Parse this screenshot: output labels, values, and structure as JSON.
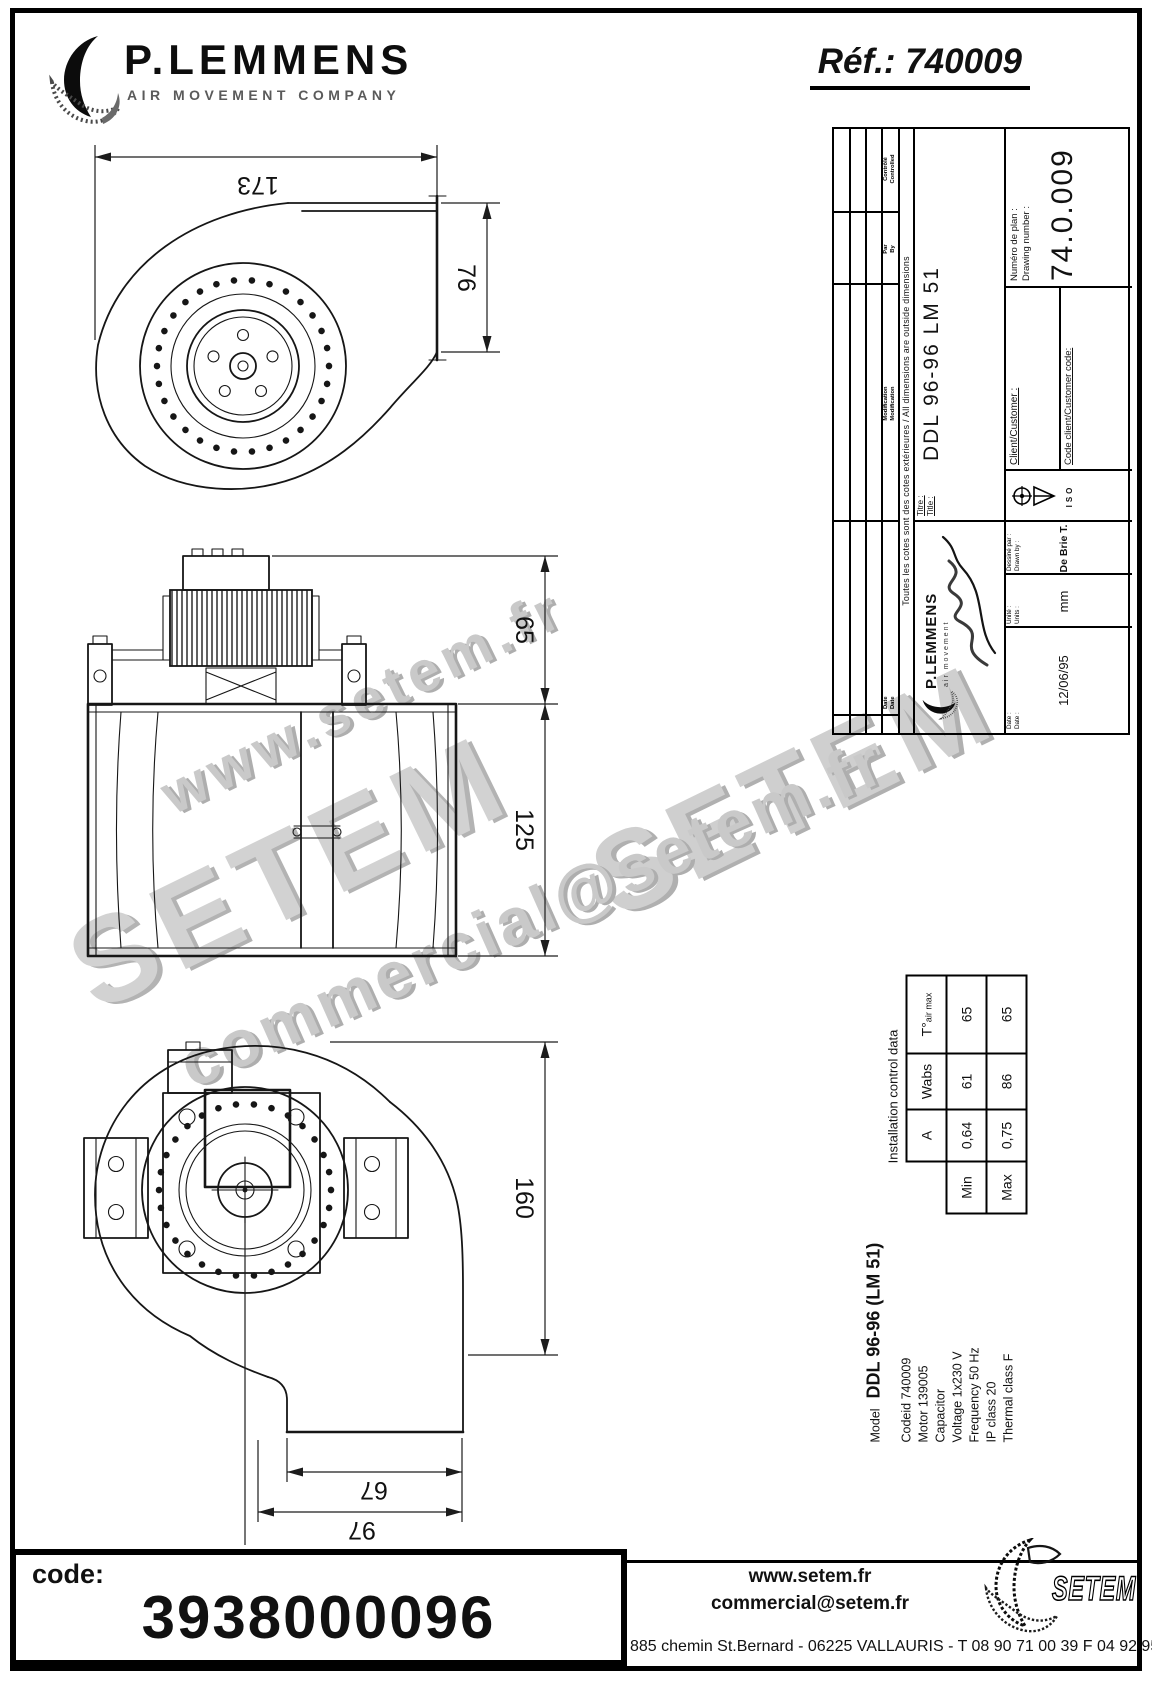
{
  "header": {
    "brand": "P.LEMMENS",
    "brand_sub": "AIR MOVEMENT COMPANY",
    "ref": "Réf.: 740009"
  },
  "dims": {
    "width_top": "173",
    "outlet": "76",
    "motor": "65",
    "housing": "125",
    "overall": "160",
    "base_inner": "67",
    "base_outer": "97"
  },
  "tb": {
    "rev": {
      "date_fr": "Date",
      "date_en": "Date",
      "mod_fr": "Modification",
      "mod_en": "Modification",
      "par_fr": "Par",
      "par_en": "By",
      "ctl_fr": "Contrôlé",
      "ctl_en": "Controlled"
    },
    "note": "Toutes les cotes sont des cotes extérieures / All dimensions are outside dimensions",
    "title_fr": "Titre :",
    "title_en": "Title :",
    "title_val": "DDL 96-96 LM 51",
    "num_fr": "Numéro de plan :",
    "num_en": "Drawing number :",
    "num_val": "74.0.009",
    "client": "Client/Customer :",
    "client_code": "Code client/Customer code:",
    "iso": "ISO",
    "date_fr": "Date :",
    "date_en": "Date :",
    "date_val": "12/06/95",
    "unit_fr": "Unité :",
    "unit_en": "Units :",
    "unit_val": "mm",
    "drawn_fr": "Dessiné par :",
    "drawn_en": "Drawn by :",
    "drawn_val": "De Brie T.",
    "logo_brand": "P.LEMMENS",
    "logo_sub": "air movement"
  },
  "specs": {
    "model_label": "Model",
    "model_val": "DDL 96-96 (LM 51)",
    "rows": [
      "Codeid 740009",
      "Motor 139005",
      "Capacitor",
      "Voltage 1x230 V",
      "Frequency 50 Hz",
      "IP class 20",
      "Thermal class F"
    ]
  },
  "itable": {
    "title": "Installation control data",
    "h_a": "A",
    "h_w": "Wabs",
    "h_t": "T°",
    "h_t_sub": "air max",
    "min_label": "Min",
    "min_a": "0,64",
    "min_w": "61",
    "min_t": "65",
    "max_label": "Max",
    "max_a": "0,75",
    "max_w": "86",
    "max_t": "65"
  },
  "wm": {
    "l1": "www.setem.fr",
    "l2": "SETEM",
    "l3": "SETEM",
    "l4": "commercial@setem.fr"
  },
  "footer": {
    "code_label": "code:",
    "code": "3938000096",
    "site": "www.setem.fr",
    "email": "commercial@setem.fr",
    "address": "885 chemin St.Bernard - 06225 VALLAURIS - T 08 90 71 00 39 F 04 92 95 19 39",
    "logo": "SETEM"
  }
}
